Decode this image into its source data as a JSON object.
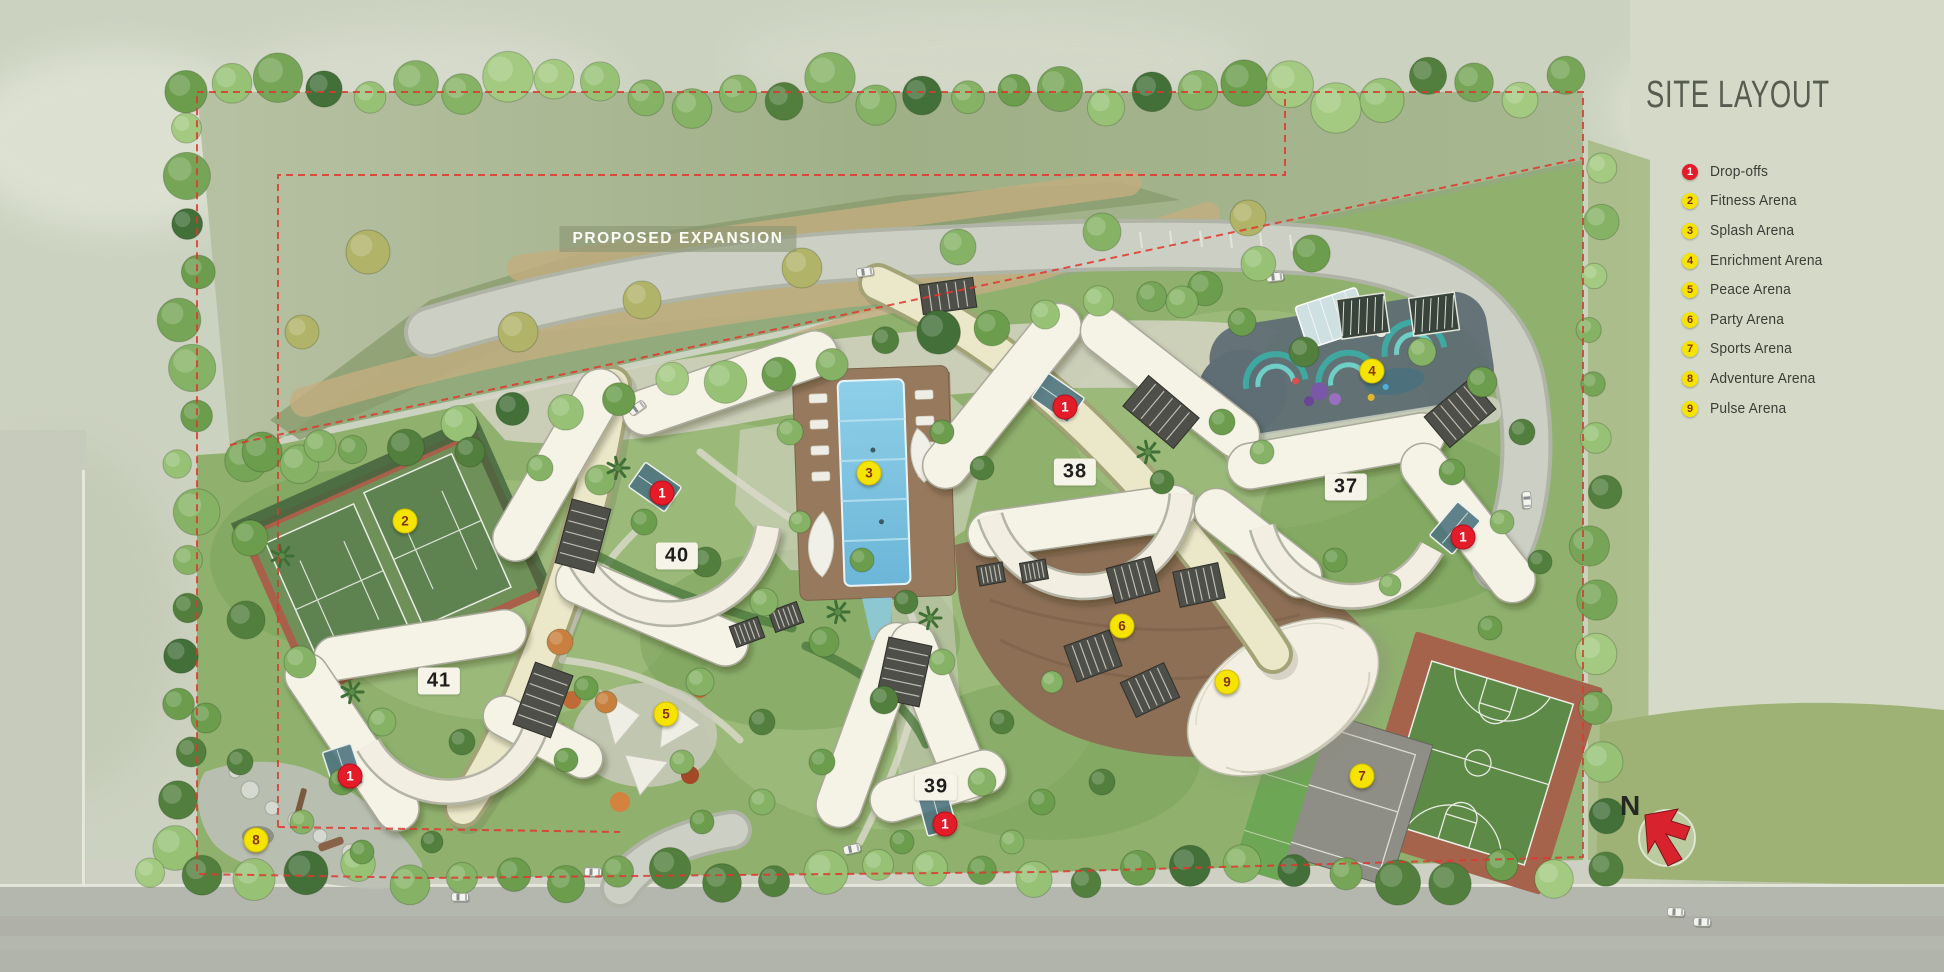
{
  "title": "SITE LAYOUT",
  "map": {
    "proposed_expansion_label": "PROPOSED EXPANSION",
    "compass_label": "N",
    "buildings": [
      {
        "number": "40"
      },
      {
        "number": "41"
      },
      {
        "number": "38"
      },
      {
        "number": "37"
      },
      {
        "number": "39"
      }
    ],
    "dropoffs": [
      {
        "label": "1"
      },
      {
        "label": "1"
      },
      {
        "label": "1"
      },
      {
        "label": "1"
      },
      {
        "label": "1"
      }
    ],
    "arenas": [
      {
        "label": "2"
      },
      {
        "label": "3"
      },
      {
        "label": "4"
      },
      {
        "label": "5"
      },
      {
        "label": "6"
      },
      {
        "label": "7"
      },
      {
        "label": "8"
      },
      {
        "label": "9"
      }
    ]
  },
  "legend": {
    "items": [
      {
        "num": "1",
        "label": "Drop-offs",
        "marker_color": "#e41b28",
        "num_color": "#ffffff"
      },
      {
        "num": "2",
        "label": "Fitness Arena",
        "marker_color": "#f4e400",
        "num_color": "#87310f"
      },
      {
        "num": "3",
        "label": "Splash Arena",
        "marker_color": "#f4e400",
        "num_color": "#87310f"
      },
      {
        "num": "4",
        "label": "Enrichment Arena",
        "marker_color": "#f4e400",
        "num_color": "#87310f"
      },
      {
        "num": "5",
        "label": "Peace Arena",
        "marker_color": "#f4e400",
        "num_color": "#87310f"
      },
      {
        "num": "6",
        "label": "Party Arena",
        "marker_color": "#f4e400",
        "num_color": "#87310f"
      },
      {
        "num": "7",
        "label": "Sports Arena",
        "marker_color": "#f4e400",
        "num_color": "#87310f"
      },
      {
        "num": "8",
        "label": "Adventure Arena",
        "marker_color": "#f4e400",
        "num_color": "#87310f"
      },
      {
        "num": "9",
        "label": "Pulse Arena",
        "marker_color": "#f4e400",
        "num_color": "#87310f"
      }
    ]
  },
  "colors": {
    "boundary_red": "#e0372e",
    "building_cream": "#f5f2e6",
    "tower_cream": "#ebe8ca",
    "pool_blue": "#7cc4e4",
    "north_arrow_red": "#d8232e",
    "title_gray": "#575c50"
  }
}
